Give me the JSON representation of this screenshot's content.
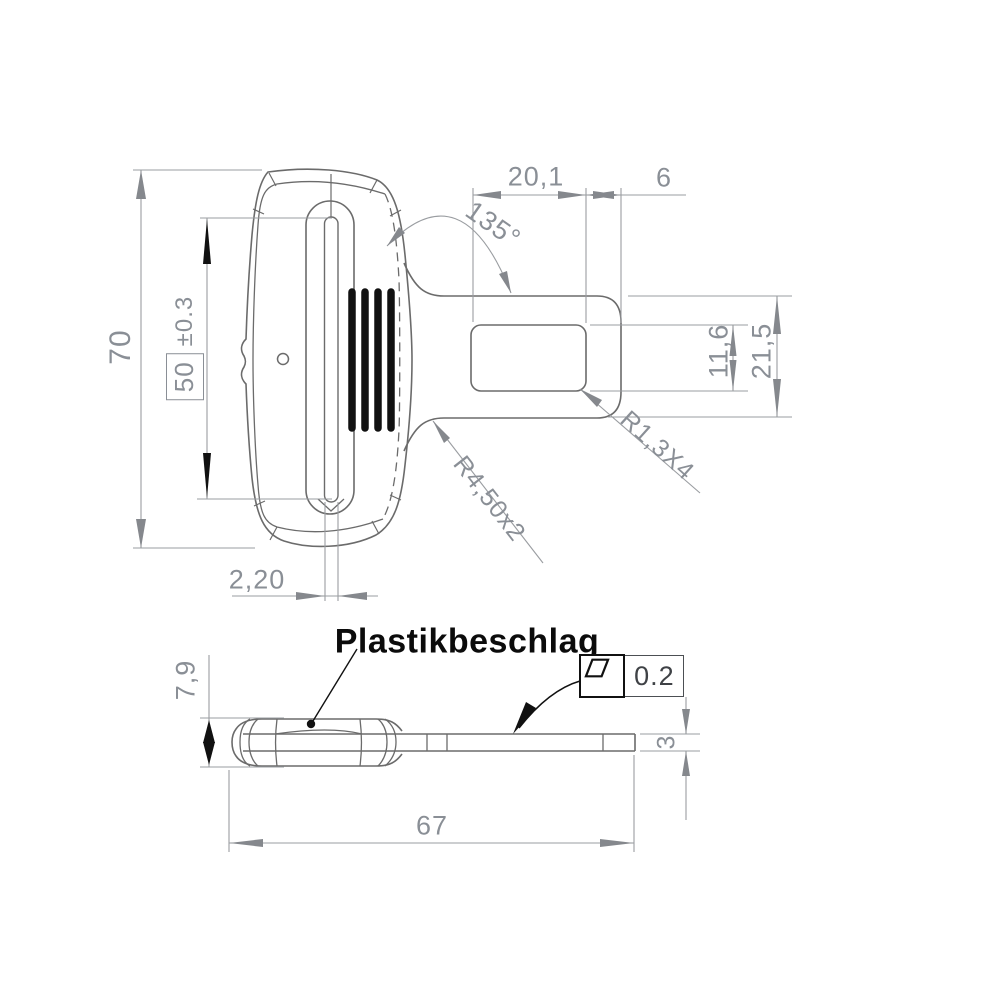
{
  "drawing": {
    "part_label": "Plastikbeschlag"
  },
  "colors": {
    "background": "#ffffff",
    "part_line": "#6b6b6b",
    "dimension_line": "#9a9da1",
    "dimension_text": "#8a8f96",
    "emphasis_black": "#111111"
  },
  "front_view": {
    "overall_height": "70",
    "slot_length": "50",
    "slot_length_tolerance": "±0.3",
    "tongue_slot_width": "20,1",
    "tip_to_slot": "6",
    "neck_angle": "135°",
    "tongue_slot_height": "11,6",
    "tongue_height": "21,5",
    "slot_corner_radius": "R1,3X4",
    "neck_fillet_radius": "R4,50x2",
    "center_slit_width": "2,20"
  },
  "side_view": {
    "body_thickness": "7,9",
    "strap_thickness": "3",
    "overall_length": "67",
    "flatness_tolerance": "0.2",
    "flatness_symbol": "flatness-parallelogram-icon"
  }
}
